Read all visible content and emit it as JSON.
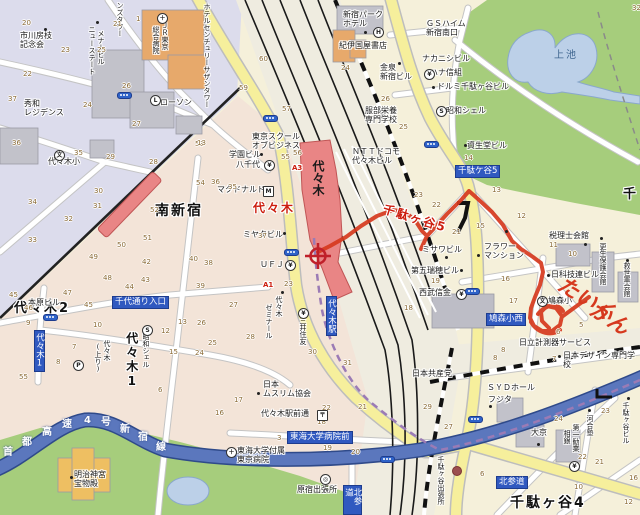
{
  "map": {
    "palette": {
      "land_west": "#dcdcec",
      "land_south": "#f3e4d8",
      "land_east": "#f5f0da",
      "park_green": "#a6cd7c",
      "pond_blue": "#bcd0e8",
      "expressway_blue": "#5b77bd",
      "subway_oedo_purple": "#9b7bb5",
      "road_yellow": "#f6ef9c",
      "rail_black": "#1a1a1a",
      "station_red": "#e98585",
      "route_red": "#d6391e",
      "sign_blue": "#3059c0"
    },
    "station_name": "代々木",
    "marker": {
      "kind": "current-location-crosshair",
      "x": 318,
      "y": 256
    },
    "labels": [
      {
        "t": "南新宿",
        "x": 155,
        "y": 203,
        "c": "area"
      },
      {
        "t": "代々木2",
        "x": 14,
        "y": 302,
        "c": "area",
        "fs": 13
      },
      {
        "t": "代々木1",
        "x": 124,
        "y": 332,
        "c": "area vert",
        "fs": 12
      },
      {
        "t": "千駄ヶ谷4",
        "x": 510,
        "y": 495,
        "c": "area"
      },
      {
        "t": "千",
        "x": 623,
        "y": 188,
        "c": "area",
        "fs": 13
      },
      {
        "t": "上池",
        "x": 554,
        "y": 50,
        "c": "pond-t"
      },
      {
        "t": "代々木",
        "x": 253,
        "y": 202,
        "c": "area red",
        "fs": 12
      },
      {
        "t": "千駄ヶ谷5",
        "x": 385,
        "y": 203,
        "c": "area red",
        "fs": 12,
        "rot": 17
      },
      {
        "t": "千駄ケ谷5",
        "x": 455,
        "y": 165,
        "c": "bb"
      },
      {
        "t": "千代通り入口",
        "x": 112,
        "y": 296,
        "c": "bb"
      },
      {
        "t": "代々木1",
        "x": 34,
        "y": 330,
        "c": "bb vert"
      },
      {
        "t": "代々木駅",
        "x": 326,
        "y": 296,
        "c": "bb vert"
      },
      {
        "t": "東海大学病院前",
        "x": 287,
        "y": 431,
        "c": "bb"
      },
      {
        "t": "鳩森小西",
        "x": 486,
        "y": 313,
        "c": "bb"
      },
      {
        "t": "北参道",
        "x": 496,
        "y": 476,
        "c": "bb"
      },
      {
        "t": "北参道",
        "x": 343,
        "y": 485,
        "c": "bb vert"
      },
      {
        "t": "A3",
        "x": 292,
        "y": 164,
        "c": "exit"
      },
      {
        "t": "A1",
        "x": 263,
        "y": 281,
        "c": "exit"
      },
      {
        "t": "市川房枝\n記念会",
        "x": 20,
        "y": 31
      },
      {
        "t": "秀和\nレジデンス",
        "x": 24,
        "y": 99
      },
      {
        "t": "ローソン",
        "x": 160,
        "y": 98
      },
      {
        "t": "代々木小",
        "x": 48,
        "y": 157
      },
      {
        "t": "ンズタワー",
        "x": 116,
        "y": 2,
        "c": "vert",
        "fs": 7
      },
      {
        "t": "ニューステート",
        "x": 88,
        "y": 26,
        "c": "vert",
        "fs": 7
      },
      {
        "t": "メナービル",
        "x": 97,
        "y": 30,
        "c": "vert",
        "fs": 7
      },
      {
        "t": "ＪＲ東京",
        "x": 161,
        "y": 22,
        "c": "vert",
        "fs": 7
      },
      {
        "t": "総合病院",
        "x": 152,
        "y": 26,
        "c": "vert",
        "fs": 7
      },
      {
        "t": "ホテルセンチュリーサザンタワー",
        "x": 203,
        "y": 3,
        "c": "vert",
        "fs": 7
      },
      {
        "t": "新宿パーク\nホテル",
        "x": 343,
        "y": 10
      },
      {
        "t": "紀伊国屋書店",
        "x": 339,
        "y": 41
      },
      {
        "t": "金泉\n新宿ビル",
        "x": 380,
        "y": 63
      },
      {
        "t": "服部栄養\n専門学校",
        "x": 365,
        "y": 106
      },
      {
        "t": "ＮＴＴドコモ\n代々木ビル",
        "x": 352,
        "y": 147
      },
      {
        "t": "東京スクール\nオブビジネス",
        "x": 252,
        "y": 132
      },
      {
        "t": "学園ビル",
        "x": 229,
        "y": 150
      },
      {
        "t": "八千代",
        "x": 236,
        "y": 160
      },
      {
        "t": "マクドナルド",
        "x": 217,
        "y": 185
      },
      {
        "t": "ミヤタビル",
        "x": 243,
        "y": 230
      },
      {
        "t": "ＵＦＪ",
        "x": 260,
        "y": 260
      },
      {
        "t": "代々木",
        "x": 275,
        "y": 296,
        "c": "vert",
        "fs": 7
      },
      {
        "t": "ゼミナール",
        "x": 265,
        "y": 304,
        "c": "vert",
        "fs": 7
      },
      {
        "t": "三井住友",
        "x": 299,
        "y": 317,
        "c": "vert",
        "fs": 7
      },
      {
        "t": "ＧＳハイム\n新宿南口",
        "x": 426,
        "y": 19
      },
      {
        "t": "ナカニシビル",
        "x": 422,
        "y": 54
      },
      {
        "t": "ハナ信組",
        "x": 430,
        "y": 68
      },
      {
        "t": "ドルミ千駄ヶ谷ビル",
        "x": 437,
        "y": 82
      },
      {
        "t": "昭和シェル",
        "x": 446,
        "y": 106
      },
      {
        "t": "資生堂ビル",
        "x": 467,
        "y": 141
      },
      {
        "t": "ミサワビル",
        "x": 422,
        "y": 245
      },
      {
        "t": "フラワー\nマンション",
        "x": 484,
        "y": 242
      },
      {
        "t": "第五瑞穂ビル",
        "x": 411,
        "y": 266
      },
      {
        "t": "西武信金",
        "x": 419,
        "y": 288
      },
      {
        "t": "税理士会館",
        "x": 549,
        "y": 231
      },
      {
        "t": "更生保護会館",
        "x": 599,
        "y": 243,
        "c": "vert",
        "fs": 7
      },
      {
        "t": "救世軍会館",
        "x": 623,
        "y": 262,
        "c": "vert",
        "fs": 7
      },
      {
        "t": "日科技連ビル",
        "x": 551,
        "y": 270
      },
      {
        "t": "鳩森小",
        "x": 548,
        "y": 296
      },
      {
        "t": "日立計測器サービス",
        "x": 519,
        "y": 338
      },
      {
        "t": "日本デザイン専門学校",
        "x": 563,
        "y": 351
      },
      {
        "t": "日本共産党",
        "x": 412,
        "y": 369
      },
      {
        "t": "ＳＹＤホール",
        "x": 487,
        "y": 383
      },
      {
        "t": "フジタ",
        "x": 488,
        "y": 395
      },
      {
        "t": "大京",
        "x": 531,
        "y": 428
      },
      {
        "t": "河合塾",
        "x": 586,
        "y": 415,
        "c": "vert",
        "fs": 7
      },
      {
        "t": "第一勧業",
        "x": 572,
        "y": 424,
        "c": "vert",
        "fs": 7
      },
      {
        "t": "相銀",
        "x": 563,
        "y": 430,
        "c": "vert",
        "fs": 7
      },
      {
        "t": "千駄ヶ谷ビル",
        "x": 622,
        "y": 402,
        "c": "vert",
        "fs": 7
      },
      {
        "t": "千駄ヶ谷出張所",
        "x": 437,
        "y": 456,
        "c": "vert",
        "fs": 7
      },
      {
        "t": "原宿出張所",
        "x": 297,
        "y": 485
      },
      {
        "t": "東海大学付属\n東京病院",
        "x": 237,
        "y": 446
      },
      {
        "t": "代々木駅前通",
        "x": 261,
        "y": 409
      },
      {
        "t": "日本\nムスリム協会",
        "x": 263,
        "y": 380
      },
      {
        "t": "本原ビル",
        "x": 28,
        "y": 298
      },
      {
        "t": "代々木",
        "x": 103,
        "y": 340,
        "c": "vert",
        "fs": 7
      },
      {
        "t": "(上り)",
        "x": 94,
        "y": 343,
        "c": "vert",
        "fs": 7
      },
      {
        "t": "昭和シェル",
        "x": 142,
        "y": 333,
        "c": "vert",
        "fs": 7
      },
      {
        "t": "明治神宮\n宝物殿",
        "x": 74,
        "y": 470
      },
      {
        "t": "首",
        "x": 3,
        "y": 447,
        "c": "exp"
      },
      {
        "t": "都",
        "x": 22,
        "y": 437,
        "c": "exp"
      },
      {
        "t": "高",
        "x": 42,
        "y": 427,
        "c": "exp"
      },
      {
        "t": "速",
        "x": 62,
        "y": 419,
        "c": "exp"
      },
      {
        "t": "4",
        "x": 84,
        "y": 415,
        "c": "exp"
      },
      {
        "t": "号",
        "x": 101,
        "y": 417,
        "c": "exp"
      },
      {
        "t": "新",
        "x": 120,
        "y": 424,
        "c": "exp"
      },
      {
        "t": "宿",
        "x": 138,
        "y": 432,
        "c": "exp"
      },
      {
        "t": "線",
        "x": 156,
        "y": 442,
        "c": "exp"
      },
      {
        "t": "たいく",
        "x": 566,
        "y": 272,
        "c": "hand",
        "rot": 32
      },
      {
        "t": "かん",
        "x": 598,
        "y": 297,
        "c": "hand",
        "rot": 32
      }
    ],
    "block_numbers": [
      [
        20,
        22,
        19
      ],
      [
        21,
        113,
        20
      ],
      [
        1,
        136,
        15
      ],
      [
        23,
        61,
        46
      ],
      [
        25,
        97,
        46
      ],
      [
        22,
        23,
        70
      ],
      [
        26,
        122,
        82
      ],
      [
        37,
        8,
        95
      ],
      [
        24,
        83,
        101
      ],
      [
        27,
        132,
        120
      ],
      [
        36,
        12,
        139
      ],
      [
        35,
        74,
        149
      ],
      [
        29,
        106,
        153
      ],
      [
        28,
        149,
        158
      ],
      [
        53,
        195,
        140
      ],
      [
        60,
        259,
        55
      ],
      [
        24,
        341,
        64
      ],
      [
        59,
        239,
        84
      ],
      [
        26,
        381,
        95
      ],
      [
        57,
        282,
        105
      ],
      [
        25,
        399,
        123
      ],
      [
        13,
        197,
        139
      ],
      [
        55,
        281,
        153
      ],
      [
        56,
        293,
        149
      ],
      [
        32,
        632,
        4
      ],
      [
        36,
        211,
        178
      ],
      [
        35,
        228,
        183
      ],
      [
        37,
        258,
        232
      ],
      [
        38,
        204,
        259
      ],
      [
        23,
        284,
        280
      ],
      [
        27,
        229,
        301
      ],
      [
        28,
        246,
        333
      ],
      [
        30,
        308,
        348
      ],
      [
        31,
        343,
        359
      ],
      [
        30,
        94,
        187
      ],
      [
        31,
        93,
        202
      ],
      [
        32,
        64,
        215
      ],
      [
        33,
        28,
        236
      ],
      [
        34,
        28,
        198
      ],
      [
        54,
        196,
        179
      ],
      [
        52,
        150,
        206
      ],
      [
        51,
        143,
        234
      ],
      [
        50,
        117,
        241
      ],
      [
        49,
        89,
        253
      ],
      [
        48,
        103,
        274
      ],
      [
        43,
        141,
        276
      ],
      [
        44,
        125,
        283
      ],
      [
        42,
        142,
        258
      ],
      [
        40,
        189,
        255
      ],
      [
        39,
        196,
        282
      ],
      [
        45,
        9,
        291
      ],
      [
        46,
        24,
        304
      ],
      [
        47,
        63,
        289
      ],
      [
        45,
        84,
        301
      ],
      [
        9,
        26,
        319
      ],
      [
        10,
        93,
        321
      ],
      [
        12,
        161,
        327
      ],
      [
        13,
        178,
        318
      ],
      [
        26,
        197,
        319
      ],
      [
        25,
        208,
        339
      ],
      [
        7,
        72,
        343
      ],
      [
        15,
        169,
        348
      ],
      [
        24,
        195,
        349
      ],
      [
        8,
        56,
        358
      ],
      [
        55,
        19,
        373
      ],
      [
        6,
        158,
        386
      ],
      [
        17,
        234,
        396
      ],
      [
        16,
        215,
        409
      ],
      [
        22,
        322,
        404
      ],
      [
        21,
        358,
        403
      ],
      [
        18,
        317,
        418
      ],
      [
        3,
        277,
        434
      ],
      [
        19,
        323,
        444
      ],
      [
        20,
        351,
        448
      ],
      [
        14,
        464,
        154
      ],
      [
        13,
        492,
        186
      ],
      [
        23,
        414,
        191
      ],
      [
        22,
        432,
        201
      ],
      [
        12,
        517,
        212
      ],
      [
        21,
        452,
        228
      ],
      [
        15,
        476,
        222
      ],
      [
        11,
        549,
        241
      ],
      [
        10,
        568,
        250
      ],
      [
        19,
        431,
        277
      ],
      [
        16,
        501,
        275
      ],
      [
        17,
        509,
        297
      ],
      [
        18,
        404,
        304
      ],
      [
        5,
        579,
        321
      ],
      [
        6,
        556,
        328
      ],
      [
        8,
        493,
        354
      ],
      [
        7,
        552,
        355
      ],
      [
        23,
        601,
        407
      ],
      [
        24,
        554,
        415
      ],
      [
        22,
        578,
        453
      ],
      [
        21,
        595,
        458
      ],
      [
        16,
        629,
        474
      ],
      [
        10,
        574,
        483
      ],
      [
        6,
        480,
        470
      ],
      [
        12,
        624,
        498
      ],
      [
        29,
        423,
        403
      ],
      [
        27,
        444,
        423
      ],
      [
        8,
        501,
        346
      ]
    ],
    "icons": [
      {
        "k": "hospital",
        "g": "＋",
        "x": 157,
        "y": 13
      },
      {
        "k": "hotel",
        "g": "H",
        "x": 373,
        "y": 27
      },
      {
        "k": "bank",
        "g": "¥",
        "x": 424,
        "y": 69
      },
      {
        "k": "bank",
        "g": "¥",
        "x": 264,
        "y": 160
      },
      {
        "k": "mcdonalds",
        "g": "M",
        "x": 263,
        "y": 186,
        "sq": 1
      },
      {
        "k": "bank",
        "g": "¥",
        "x": 285,
        "y": 260
      },
      {
        "k": "bank",
        "g": "¥",
        "x": 298,
        "y": 308
      },
      {
        "k": "bank",
        "g": "¥",
        "x": 456,
        "y": 289
      },
      {
        "k": "bank",
        "g": "¥",
        "x": 569,
        "y": 461
      },
      {
        "k": "school",
        "g": "文",
        "x": 54,
        "y": 150
      },
      {
        "k": "school",
        "g": "文",
        "x": 537,
        "y": 296
      },
      {
        "k": "hospital",
        "g": "＋",
        "x": 226,
        "y": 447
      },
      {
        "k": "post-office",
        "g": "〒",
        "x": 317,
        "y": 410,
        "sq": 1
      },
      {
        "k": "gas-station",
        "g": "S",
        "x": 436,
        "y": 106
      },
      {
        "k": "gas-station",
        "g": "S",
        "x": 142,
        "y": 325
      },
      {
        "k": "parking",
        "g": "P",
        "x": 73,
        "y": 360
      },
      {
        "k": "convenience-store",
        "g": "L",
        "x": 150,
        "y": 95
      },
      {
        "k": "ward-office",
        "g": "◎",
        "x": 320,
        "y": 474
      }
    ],
    "dots": [
      [
        44,
        28
      ],
      [
        96,
        21
      ],
      [
        260,
        153
      ],
      [
        283,
        232
      ],
      [
        281,
        291
      ],
      [
        257,
        392
      ],
      [
        398,
        62
      ],
      [
        464,
        144
      ],
      [
        432,
        86
      ],
      [
        445,
        256
      ],
      [
        477,
        254
      ],
      [
        460,
        269
      ],
      [
        584,
        243
      ],
      [
        600,
        237
      ],
      [
        626,
        259
      ],
      [
        547,
        274
      ],
      [
        558,
        355
      ],
      [
        489,
        405
      ],
      [
        537,
        443
      ],
      [
        588,
        409
      ],
      [
        627,
        397
      ],
      [
        70,
        476
      ],
      [
        364,
        31
      ],
      [
        505,
        230
      ]
    ],
    "signals": [
      [
        284,
        249
      ],
      [
        43,
        314
      ],
      [
        263,
        115
      ],
      [
        465,
        288
      ],
      [
        468,
        416
      ],
      [
        380,
        456
      ],
      [
        424,
        141
      ],
      [
        117,
        92
      ]
    ],
    "spots": [
      [
        452,
        466
      ]
    ]
  }
}
